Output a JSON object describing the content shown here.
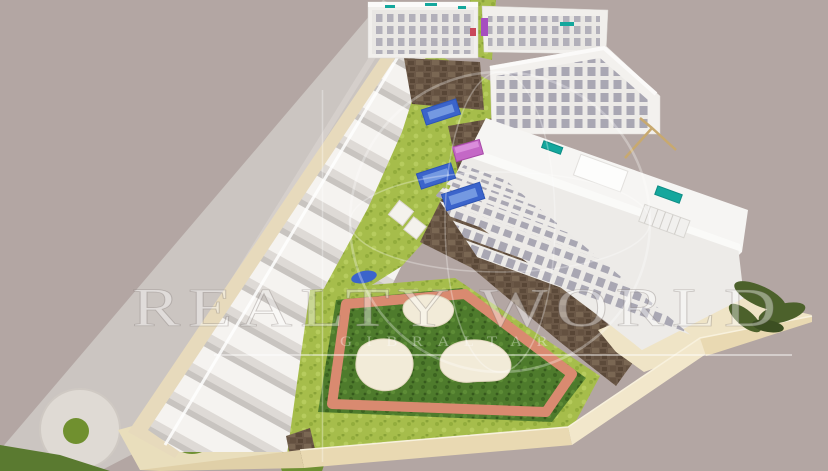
{
  "image": {
    "type": "3D architectural site model render",
    "description": "Aerial view of a triangular residential development model: a row of white terraced townhouses along an access road, four white apartment blocks, communal gardens with blue swimming pools, a pink pergola, dark stone retaining walls, and a landscaped park with a salmon running track and three sand play areas, all set on a pale mauve background.",
    "background_color": "#b3a6a3"
  },
  "watermark": {
    "brand": "REALTY WORLD",
    "subtitle": "GIBRALTAR",
    "icon": "globe-circle",
    "text_color": "rgba(255,255,255,0.40)"
  },
  "scene": {
    "counts": {
      "apartment_blocks": 4,
      "ground_pools": 3,
      "garden_ponds": 1,
      "rooftop_pools": 3,
      "park_sand_areas": 3,
      "roundabouts": 1,
      "tree_circles": 2
    },
    "colors": {
      "background_mauve": "#b3a6a3",
      "road_gray": "#cbc5c1",
      "building_white": "#f1efec",
      "window_gray": "#adabb6",
      "grass_light": "#a6bd4b",
      "grass_dark": "#4e7b2c",
      "running_track_salmon": "#d98a70",
      "pool_blue": "#3b64cb",
      "rooftop_pool_teal": "#14a79d",
      "pergola_pink": "#c468c6",
      "stone_wall_brown": "#6b5847",
      "ground_sand_beige": "#e8dcbf",
      "slab_edge_cream": "#ecdcb4"
    }
  }
}
